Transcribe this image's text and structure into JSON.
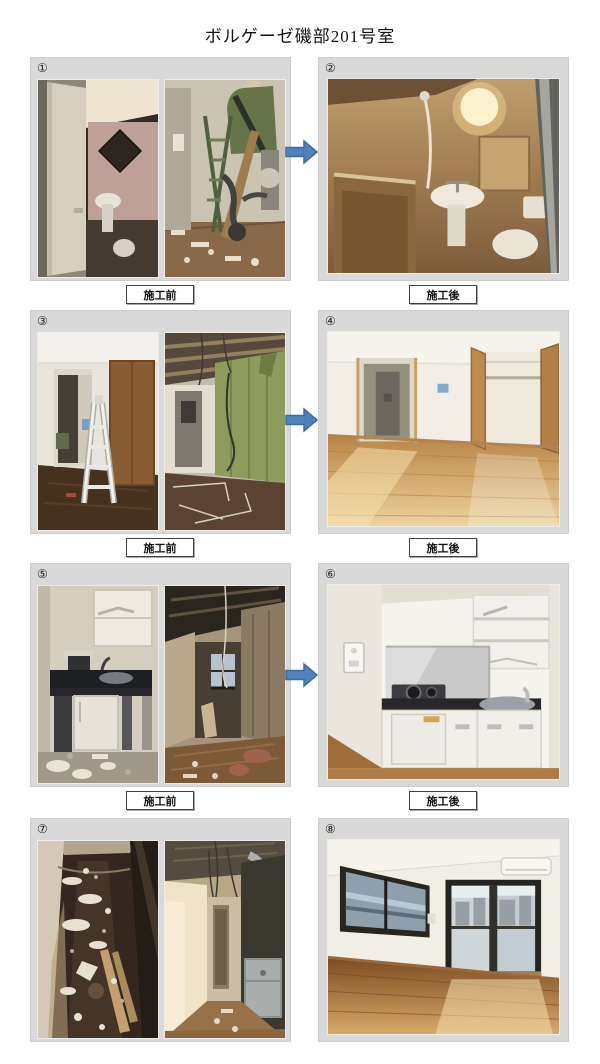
{
  "page": {
    "title": "ボルゲーゼ磯部201号室"
  },
  "labels": {
    "before": "施工前",
    "after": "施工後"
  },
  "arrow_color": "#4f81bd",
  "rows": [
    {
      "before_number": "①",
      "after_number": "②",
      "before_photos": [
        {
          "desc": "浴室 解体前（開いたドア越しの旧ユニットバス）"
        },
        {
          "desc": "浴室 解体中（脚立・露出配管・作業員）"
        }
      ],
      "after_photo": {
        "desc": "浴室 施工後（新しいユニットバス・洗面台・トイレ）"
      }
    },
    {
      "before_number": "③",
      "after_number": "④",
      "before_photos": [
        {
          "desc": "居室 解体前（廊下と脚立）"
        },
        {
          "desc": "居室 解体中（断熱材壁・露出配線）"
        }
      ],
      "after_photo": {
        "desc": "居室 施工後（フローリング・クローゼット）"
      }
    },
    {
      "before_number": "⑤",
      "after_number": "⑥",
      "before_photos": [
        {
          "desc": "キッチン 解体前（旧流し台）"
        },
        {
          "desc": "キッチン 解体中（天井解体・廃材）"
        }
      ],
      "after_photo": {
        "desc": "キッチン 施工後（白いキッチンユニット）"
      }
    },
    {
      "before_number": "⑦",
      "after_number": "⑧",
      "before_photos": [
        {
          "desc": "廊下 解体中（床の粉塵・廃材）"
        },
        {
          "desc": "廊下 解体中（垂れ下がる配線）"
        }
      ],
      "after_photo": {
        "desc": "居室 施工後（窓・バルコニー・エアコン）"
      }
    }
  ]
}
